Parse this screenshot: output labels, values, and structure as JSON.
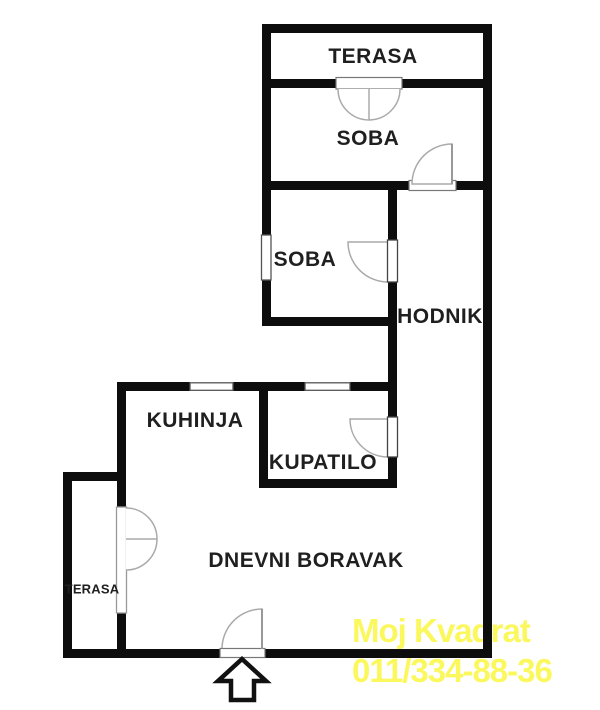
{
  "plan": {
    "type": "apartment-floor-plan",
    "rooms": {
      "terasa_top": {
        "label": "TERASA"
      },
      "soba_1": {
        "label": "SOBA"
      },
      "soba_2": {
        "label": "SOBA"
      },
      "hodnik": {
        "label": "HODNIK"
      },
      "kuhinja": {
        "label": "KUHINJA"
      },
      "kupatilo": {
        "label": "KUPATILO"
      },
      "dnevni_boravak": {
        "label": "DNEVNI BORAVAK"
      },
      "terasa_left": {
        "label": "TERASA"
      }
    },
    "icons": {
      "entrance_arrow": "up-arrow-outline",
      "door_swing": "quarter-circle-arc",
      "double_door_swing": "semicircle-arc",
      "window": "thin-white-bar-in-wall"
    },
    "colors": {
      "wall": "#0d0d0d",
      "background": "#ffffff",
      "door_arc": "#aaaaaa",
      "opening_outline": "#555555",
      "label_text": "#1f1f1f"
    }
  },
  "watermark": {
    "line1": "Moj Kvadrat",
    "line2": "011/334-88-36",
    "color": "#fbf85e"
  }
}
